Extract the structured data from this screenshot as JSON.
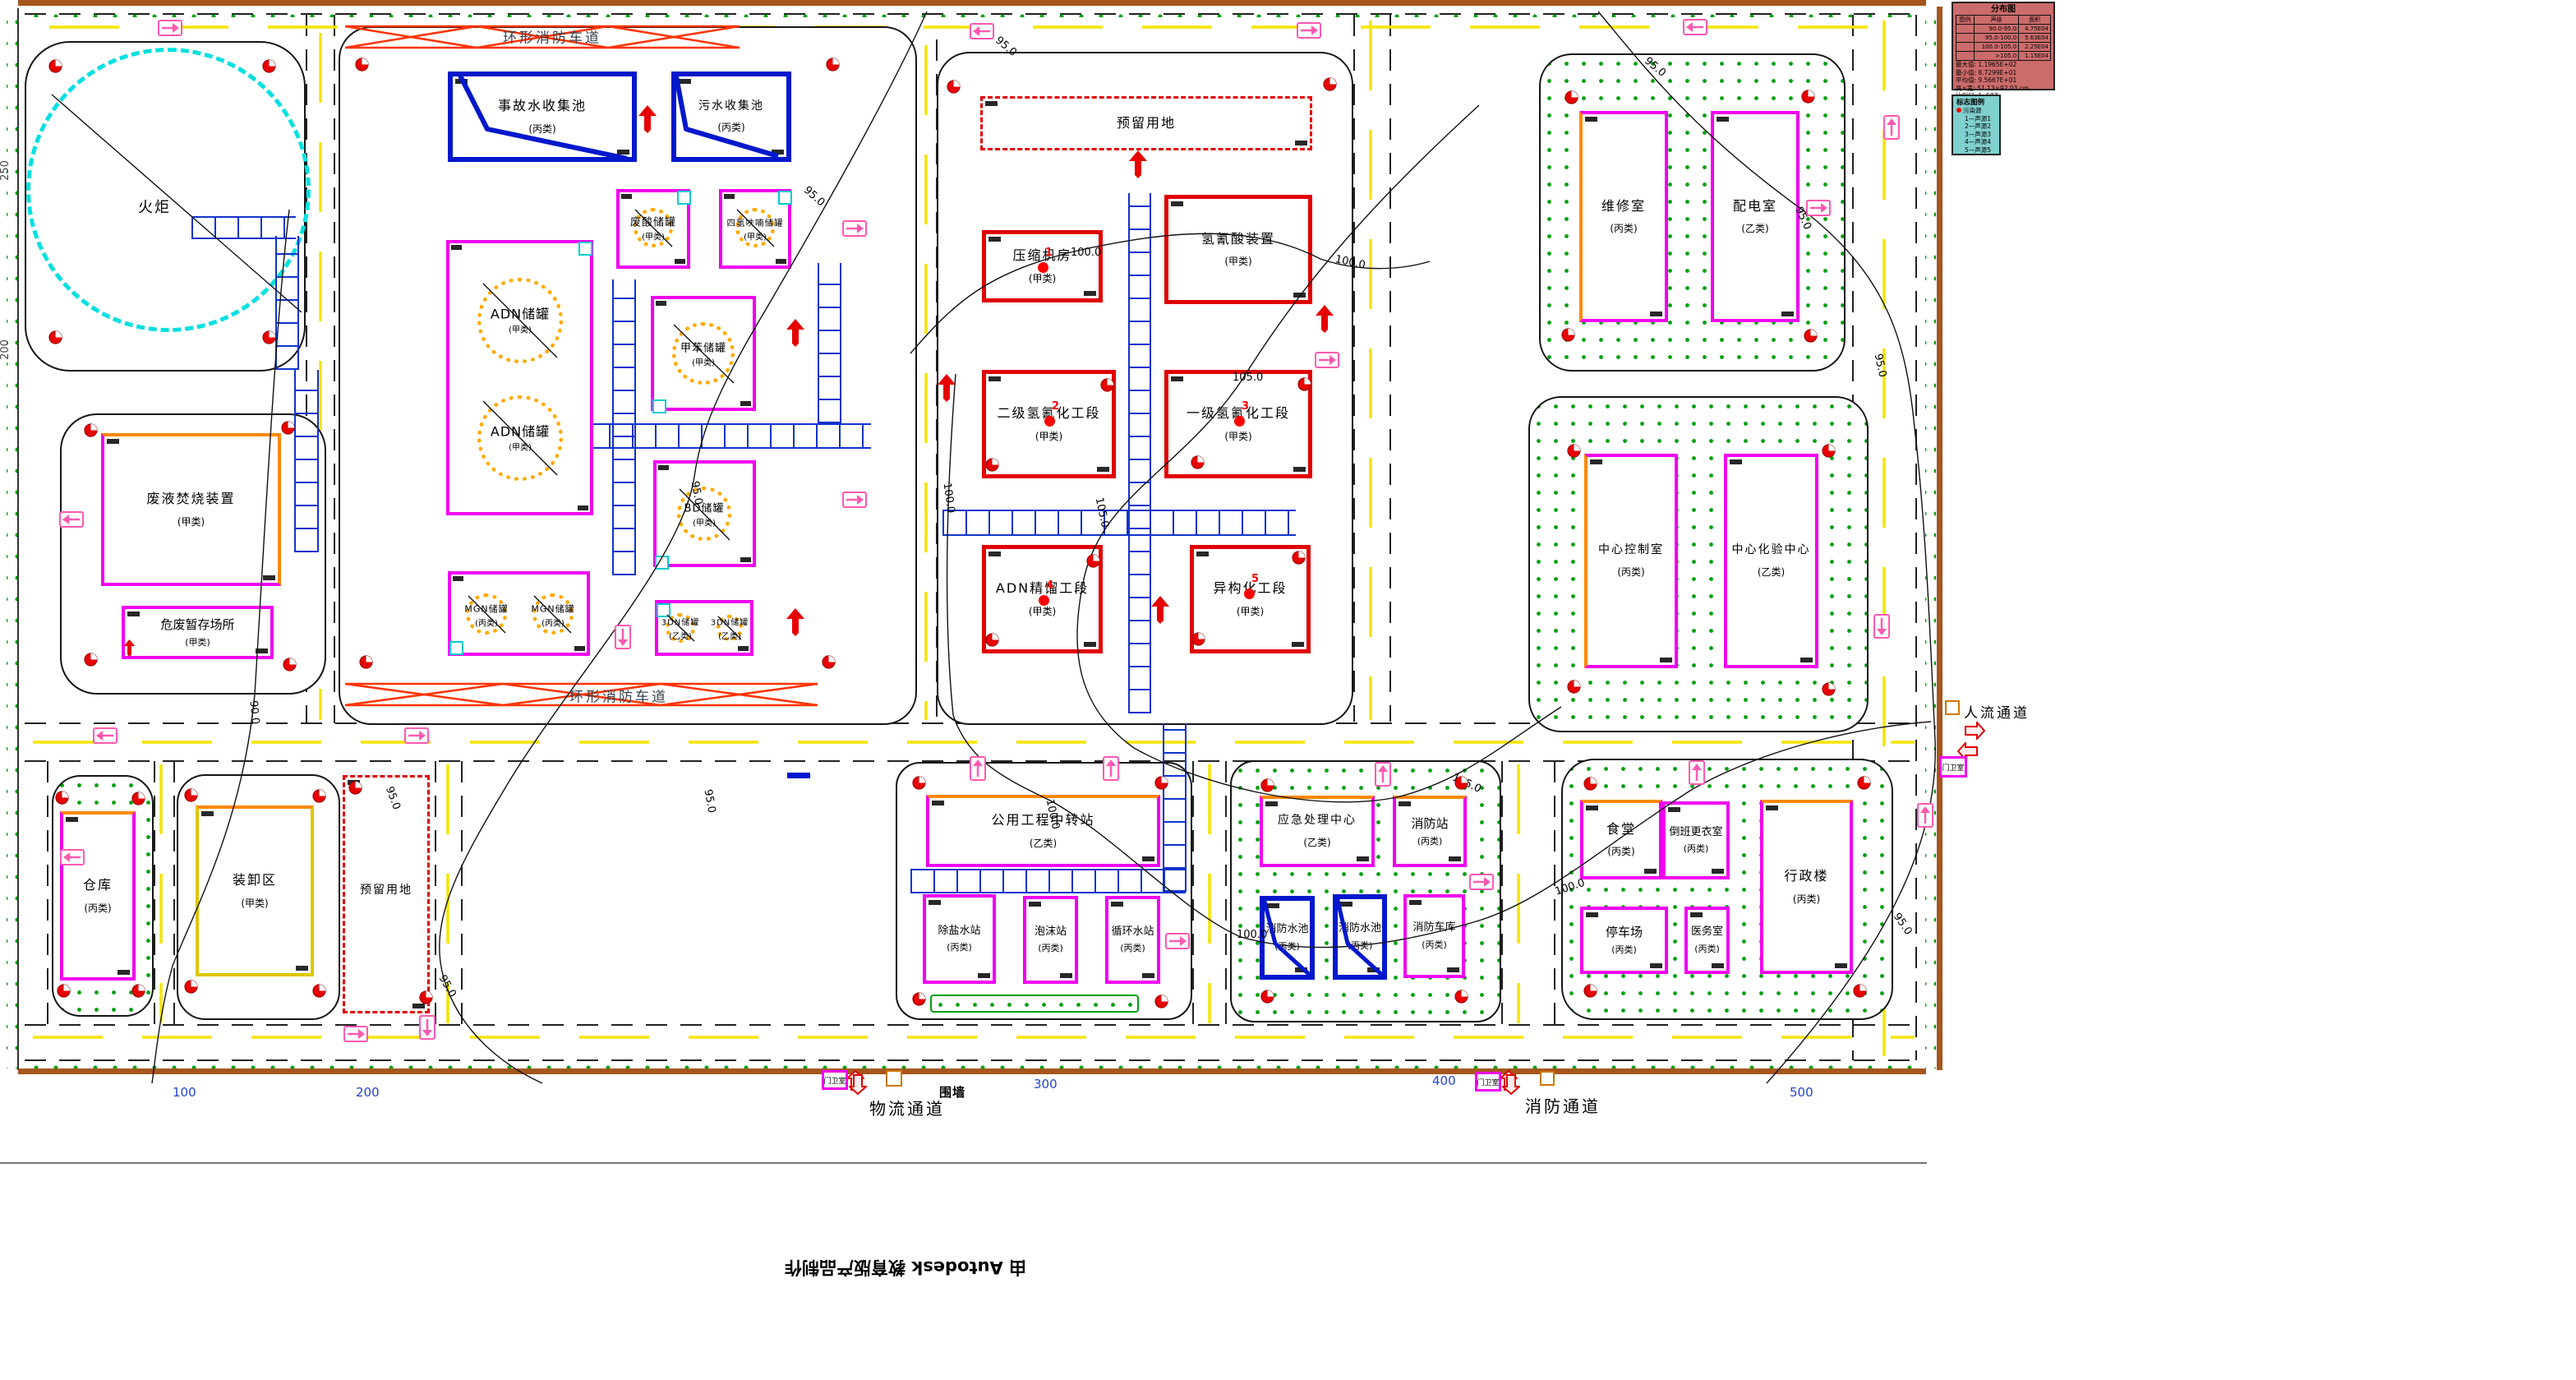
{
  "stamp": "由 Autodesk 教育版产品制作",
  "labels": {
    "ring_road": "环形消防车道",
    "people_channel": "人流通道",
    "logistics_channel": "物流通道",
    "fire_channel": "消防通道",
    "gatehouse": "门卫室",
    "wall": "围墙",
    "flare": "火炬"
  },
  "contours": {
    "c90": "90.0",
    "c95": "95.0",
    "c100": "100.0",
    "c105": "105.0"
  },
  "sources": [
    "1",
    "2",
    "3",
    "4",
    "5"
  ],
  "scale_bottom": [
    "100",
    "200",
    "300",
    "400",
    "500"
  ],
  "scale_left": [
    "250",
    "200"
  ],
  "buildings": [
    {
      "name": "事故水收集池",
      "cat": "(丙类)"
    },
    {
      "name": "污水收集池",
      "cat": "(丙类)"
    },
    {
      "name": "废酸储罐",
      "cat": "(甲类)"
    },
    {
      "name": "四氢呋喃储罐",
      "cat": "(甲类)"
    },
    {
      "name": "ADN储罐",
      "cat": "(甲类)"
    },
    {
      "name": "ADN储罐",
      "cat": "(甲类)"
    },
    {
      "name": "甲苯储罐",
      "cat": "(甲类)"
    },
    {
      "name": "BD储罐",
      "cat": "(甲类)"
    },
    {
      "name": "MGN储罐",
      "cat": "(丙类)"
    },
    {
      "name": "MGN储罐",
      "cat": "(丙类)"
    },
    {
      "name": "3DN储罐",
      "cat": "(乙类)"
    },
    {
      "name": "3DN储罐",
      "cat": "(乙类)"
    },
    {
      "name": "废液焚烧装置",
      "cat": "(甲类)"
    },
    {
      "name": "危废暂存场所",
      "cat": "(甲类)"
    },
    {
      "name": "仓库",
      "cat": "(丙类)"
    },
    {
      "name": "装卸区",
      "cat": "(甲类)"
    },
    {
      "name": "预留用地",
      "cat": ""
    },
    {
      "name": "预留用地",
      "cat": ""
    },
    {
      "name": "压缩机房",
      "cat": "(甲类)"
    },
    {
      "name": "氢氰酸装置",
      "cat": "(甲类)"
    },
    {
      "name": "二级氢氰化工段",
      "cat": "(甲类)"
    },
    {
      "name": "一级氢氰化工段",
      "cat": "(甲类)"
    },
    {
      "name": "ADN精馏工段",
      "cat": "(甲类)"
    },
    {
      "name": "异构化工段",
      "cat": "(甲类)"
    },
    {
      "name": "维修室",
      "cat": "(丙类)"
    },
    {
      "name": "配电室",
      "cat": "(乙类)"
    },
    {
      "name": "中心控制室",
      "cat": "(丙类)"
    },
    {
      "name": "中心化验中心",
      "cat": "(乙类)"
    },
    {
      "name": "公用工程中转站",
      "cat": "(乙类)"
    },
    {
      "name": "除盐水站",
      "cat": "(丙类)"
    },
    {
      "name": "泡沫站",
      "cat": "(丙类)"
    },
    {
      "name": "循环水站",
      "cat": "(丙类)"
    },
    {
      "name": "应急处理中心",
      "cat": "(乙类)"
    },
    {
      "name": "消防站",
      "cat": "(丙类)"
    },
    {
      "name": "消防水池",
      "cat": "(丙类)"
    },
    {
      "name": "消防水池",
      "cat": "(丙类)"
    },
    {
      "name": "消防车库",
      "cat": "(丙类)"
    },
    {
      "name": "食堂",
      "cat": "(丙类)"
    },
    {
      "name": "倒班更衣室",
      "cat": "(丙类)"
    },
    {
      "name": "行政楼",
      "cat": "(丙类)"
    },
    {
      "name": "停车场",
      "cat": "(丙类)"
    },
    {
      "name": "医务室",
      "cat": "(丙类)"
    },
    {
      "name": "火炬",
      "cat": ""
    }
  ],
  "legend_distribution": {
    "title": "分布图",
    "col_headers": [
      "图例",
      "声级",
      "面积"
    ],
    "rows": [
      {
        "range": "90.0-95.0",
        "area": "4.75E04"
      },
      {
        "range": "95.0-100.0",
        "area": "5.63E04"
      },
      {
        "range": "100.0-105.0",
        "area": "2.25E04"
      },
      {
        "range": ">105.0",
        "area": "1.15E04"
      }
    ],
    "stats": [
      {
        "k": "最大值:",
        "v": "1.1965E+02"
      },
      {
        "k": "最小值:",
        "v": "8.7299E+01"
      },
      {
        "k": "平均值:",
        "v": "9.5667E+01"
      },
      {
        "k": "高×宽:",
        "v": "51.13×92.03 cm"
      },
      {
        "k": "比例尺:",
        "v": "1: 587"
      }
    ]
  },
  "legend_symbols": {
    "title": "标志图例",
    "source_label": "污染源",
    "items": [
      "1—声源1",
      "2—声源2",
      "3—声源3",
      "4—声源4",
      "5—声源5"
    ]
  }
}
